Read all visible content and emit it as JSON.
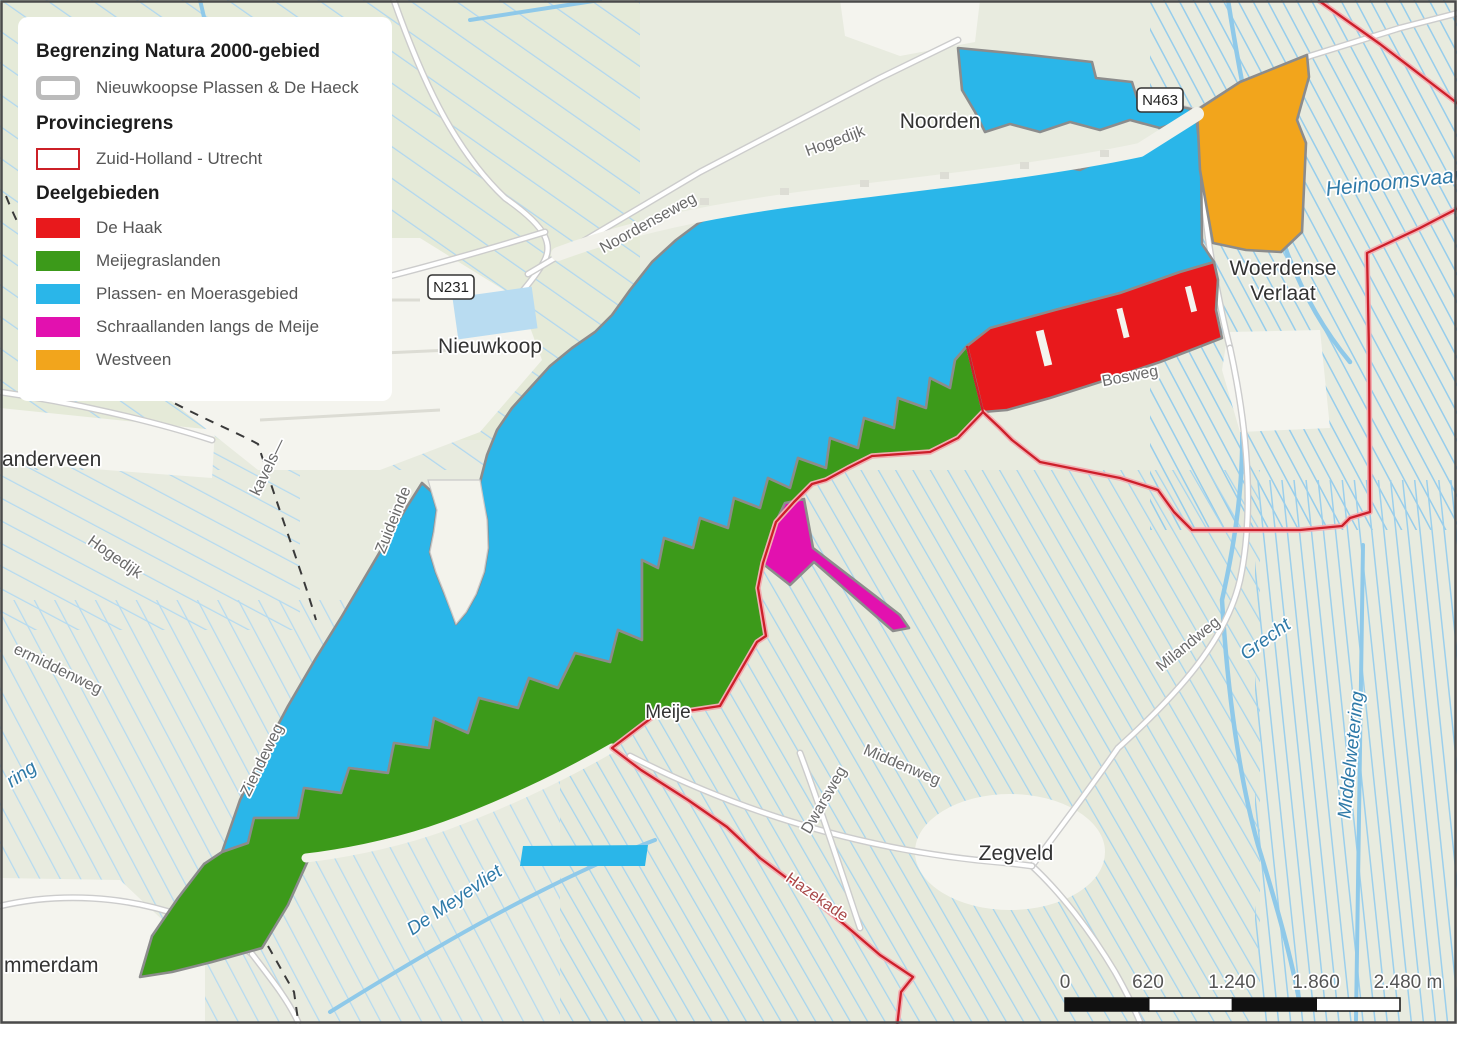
{
  "colors": {
    "plassen_cyan": "#2ab6e9",
    "meijegraslanden_green": "#3c9a1a",
    "de_haak_red": "#e8191c",
    "westveen_orange": "#f2a51c",
    "schraallanden_magenta": "#e211af",
    "province_border_red": "#cd1f2a",
    "natura_border_gray": "#8c8c8c",
    "water_blue": "#8fc9e9",
    "land_base": "#e8ebdf"
  },
  "legend": {
    "natura_title": "Begrenzing Natura 2000-gebied",
    "natura_item": "Nieuwkoopse Plassen & De Haeck",
    "province_title": "Provinciegrens",
    "province_item": "Zuid-Holland - Utrecht",
    "deel_title": "Deelgebieden",
    "deel_items": [
      {
        "label": "De Haak",
        "color": "#e8191c"
      },
      {
        "label": "Meijegraslanden",
        "color": "#3c9a1a"
      },
      {
        "label": "Plassen- en Moerasgebied",
        "color": "#2ab6e9"
      },
      {
        "label": "Schraallanden langs de Meije",
        "color": "#e211af"
      },
      {
        "label": "Westveen",
        "color": "#f2a51c"
      }
    ]
  },
  "map": {
    "towns": {
      "anderveen": "anderveen",
      "zwammerdam": "mmerdam",
      "noorden": "Noorden",
      "nieuwkoop": "Nieuwkoop",
      "woerdense_line1": "Woerdense",
      "woerdense_line2": "Verlaat",
      "zegveld": "Zegveld",
      "meije": "Meije"
    },
    "roads": {
      "hogedijk_top": "Hogedijk",
      "noordenseweg": "Noordenseweg",
      "hogedijk_left": "Hogedijk",
      "ermiddenweg": "ermiddenweg",
      "kavels": "kavels—",
      "zuideinde": "Zuideinde",
      "ziendeweg": "Ziendeweg",
      "bosweg": "Bosweg",
      "milandweg": "Milandweg",
      "middenweg": "Middenweg",
      "dwarsweg": "Dwarsweg",
      "hazekade": "Hazekade"
    },
    "waters": {
      "heinoomsvaart": "Heinoomsvaart",
      "grecht": "Grecht",
      "middelwetering": "Middelwetering",
      "de_meyevliet": "De Meyevliet",
      "ring": "ring"
    },
    "shields": {
      "n231": "N231",
      "n463": "N463"
    },
    "scalebar": {
      "ticks": [
        "0",
        "620",
        "1.240",
        "1.860",
        "2.480 m"
      ]
    }
  }
}
